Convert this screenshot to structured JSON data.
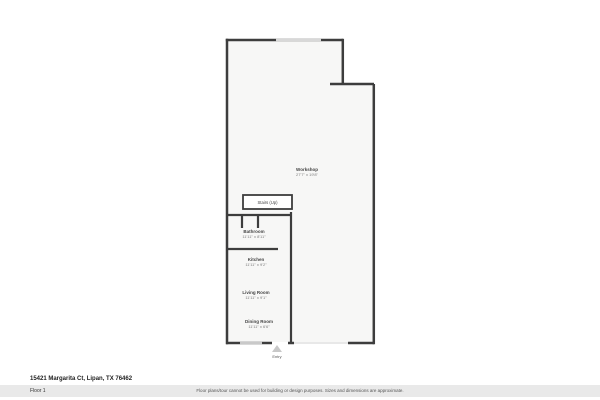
{
  "page": {
    "address": "15421 Margarita Ct, Lipan, TX 76462",
    "floor_label": "Floor 1",
    "disclaimer": "Floor plans/tour cannot be used for building or design purposes. Sizes and dimensions are approximate."
  },
  "floorplan": {
    "entry_label": "Entry",
    "rooms": [
      {
        "name": "Workshop",
        "dimensions": "27'7\" x 19'8\""
      },
      {
        "name": "Stairs (Up)",
        "dimensions": ""
      },
      {
        "name": "Bathroom",
        "dimensions": "11'11\" x 8'11\""
      },
      {
        "name": "Kitchen",
        "dimensions": "11'11\" x 9'2\""
      },
      {
        "name": "Living Room",
        "dimensions": "11'11\" x 9'1\""
      },
      {
        "name": "Dining Room",
        "dimensions": "11'11\" x 6'6\""
      }
    ],
    "colors": {
      "wall": "#3d3d3d",
      "floor": "#f7f7f6",
      "window": "#d8d8d8",
      "opening": "#e0e0e0",
      "entry_arrow": "#c8c8c8"
    }
  }
}
